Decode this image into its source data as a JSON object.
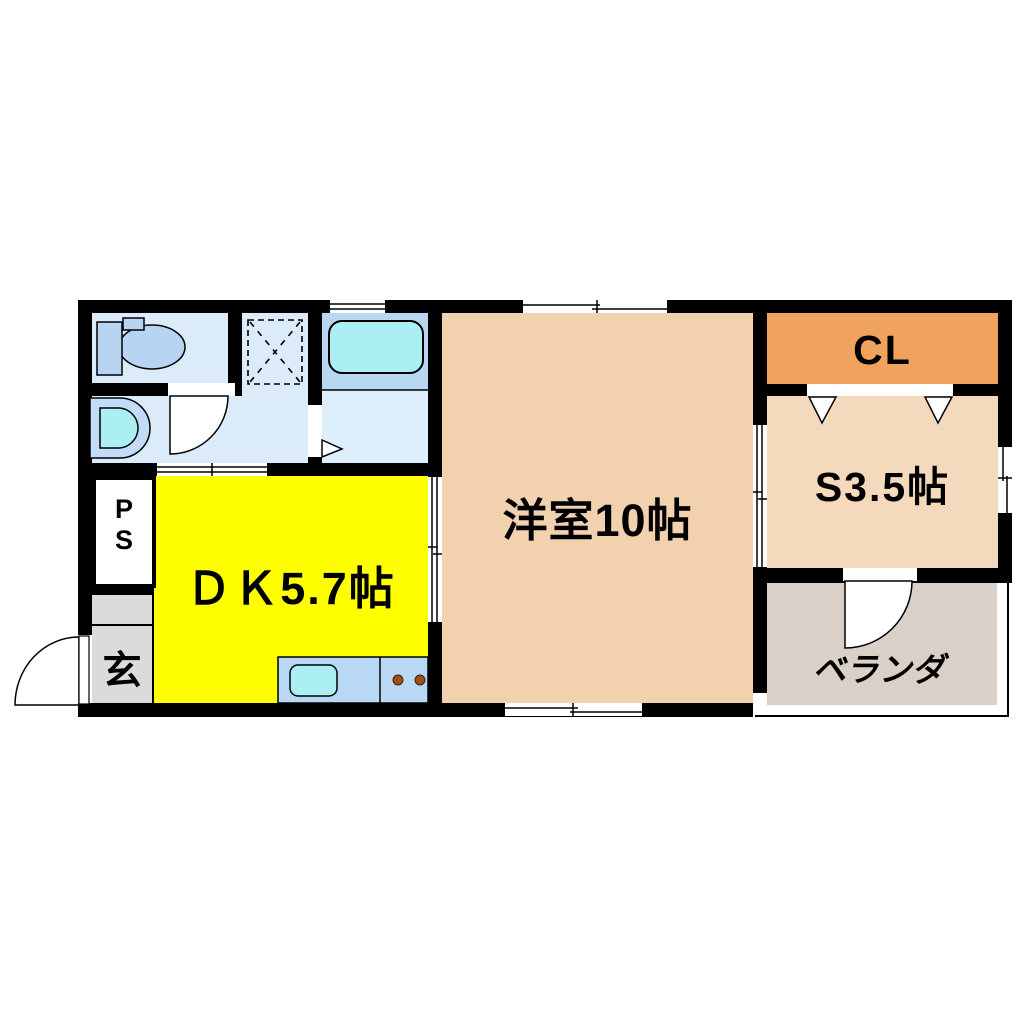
{
  "type": "apartment-floor-plan",
  "rooms": {
    "dining_kitchen": {
      "label": "ＤＫ5.7帖",
      "color": "#FFFF00"
    },
    "western_room": {
      "label": "洋室10帖",
      "color": "#F2D1AF"
    },
    "service_room": {
      "label": "S3.5帖",
      "color": "#F5D9BC"
    },
    "closet": {
      "label": "CL",
      "color": "#F0A35C"
    },
    "veranda": {
      "label": "ベランダ",
      "color": "#D9D1C8"
    },
    "entrance": {
      "label": "玄",
      "color": "#DBDBDB"
    },
    "pipe_space": {
      "label_line1": "P",
      "label_line2": "S",
      "color": "#FFFFFF"
    },
    "toilet_room": {
      "color": "#DCEBFA"
    },
    "washroom": {
      "color": "#DCEBFA"
    },
    "bathroom": {
      "surround_color": "#B9D7F2",
      "floor_color": "#DDEEFC"
    }
  },
  "fixtures": {
    "toilet": "toilet-icon",
    "wash_basin": "wash-basin-icon",
    "bathtub": "bathtub-icon",
    "laundry_space": "laundry-space-dashed-box-icon",
    "kitchen_counter": "kitchen-counter-icon",
    "kitchen_sink": "kitchen-sink-icon",
    "stove_burners": "stove-burners-icon",
    "hinged_doors": "door-swing-arc-icon",
    "folding_doors": "folding-door-triangle-icon",
    "sliding_doors": "sliding-door-icon",
    "windows": "window-icon"
  },
  "palette": {
    "wall": "#000000",
    "background": "#FFFFFF",
    "water_cyan": "#ABEFF2",
    "fixture_blue": "#B7D4F2",
    "counter_blue": "#B8D8F5",
    "burner_brown": "#9A4E20"
  }
}
